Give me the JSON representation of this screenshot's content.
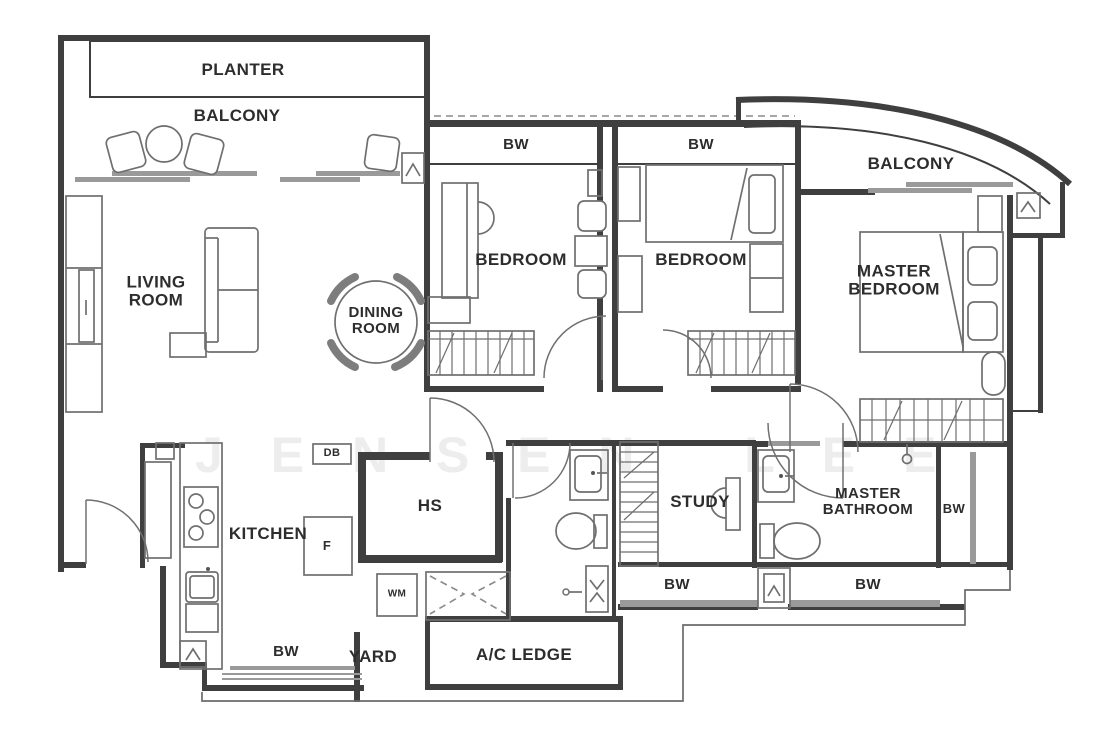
{
  "plan": {
    "rooms": {
      "planter": "PLANTER",
      "balcony_left": "BALCONY",
      "living_room": "LIVING\nROOM",
      "dining_room": "DINING\nROOM",
      "bedroom_left": "BEDROOM",
      "bedroom_mid": "BEDROOM",
      "balcony_right": "BALCONY",
      "master_bedroom": "MASTER\nBEDROOM",
      "kitchen": "KITCHEN",
      "hs": "HS",
      "study": "STUDY",
      "master_bathroom": "MASTER\nBATHROOM",
      "yard": "YARD",
      "ac_ledge": "A/C LEDGE"
    },
    "fixtures": {
      "db": "DB",
      "f": "F",
      "wm": "WM"
    },
    "windows": {
      "bw_bedroom_left": "BW",
      "bw_bedroom_mid": "BW",
      "bw_master_side": "BW",
      "bw_kitchen": "BW",
      "bw_study": "BW",
      "bw_master_bath": "BW"
    },
    "watermark": "J E N S E N   L E E",
    "colors": {
      "wall": "#3f3f3f",
      "furn": "#6f6f6f",
      "glaz": "#9a9a9a",
      "label": "#2d2d2d",
      "wm": "#ededed",
      "bg": "#ffffff"
    }
  }
}
